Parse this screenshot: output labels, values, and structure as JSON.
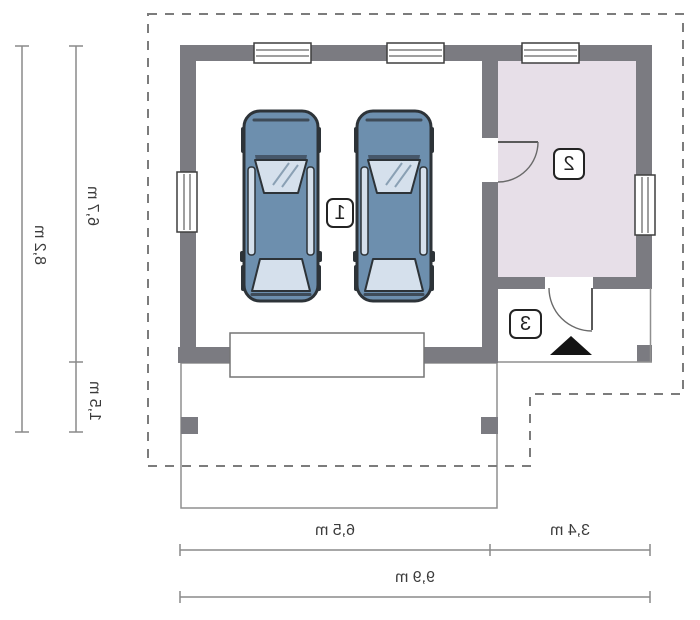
{
  "rooms": {
    "garage_label": "1",
    "storage_label": "2",
    "entry_label": "3"
  },
  "dimensions": {
    "overall_depth": "8,2 m",
    "building_depth": "6,7 m",
    "canopy_depth": "1,5 m",
    "garage_width": "6,5 m",
    "annex_width": "3,4 m",
    "overall_width": "9,9 m"
  },
  "colors": {
    "wall": "#7b7b81",
    "room2_fill": "#e7dfe8",
    "car_body": "#6d8fae",
    "car_glass": "#d5e0ec",
    "car_dark": "#3e4b58",
    "dashed_line": "#7c7c7c",
    "dimension_line": "#8a8a8a",
    "thin_line": "#8f8f8f",
    "arrow": "#141414"
  }
}
